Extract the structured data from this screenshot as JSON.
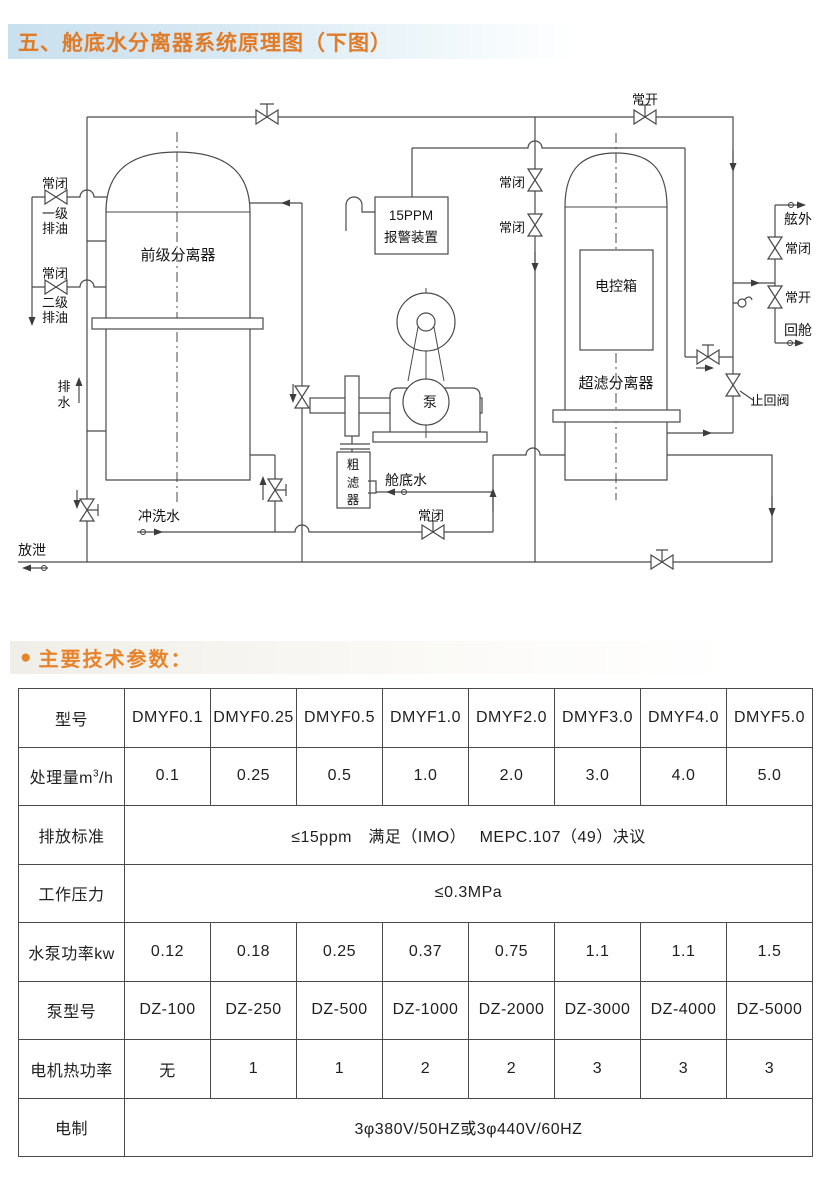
{
  "page_title": "五、舱底水分离器系统原理图（下图）",
  "params_bullet": "●",
  "params_heading": "主要技术参数：",
  "diagram": {
    "labels": {
      "normally_open": "常开",
      "normally_closed": "常闭",
      "stage1": "一级",
      "stage2": "二级",
      "oil_drain": "排油",
      "pre_separator": "前级分离器",
      "alarm_line1": "15PPM",
      "alarm_line2": "报警装置",
      "control_box": "电控箱",
      "uf_separator": "超滤分离器",
      "pump": "泵",
      "drain_char1": "排",
      "drain_char2": "水",
      "filter_char1": "粗",
      "filter_char2": "滤",
      "filter_char3": "器",
      "bilge_water": "舱底水",
      "flushing_water": "冲洗水",
      "discharge": "放泄",
      "overboard": "舷外",
      "return_cabin": "回舱",
      "check_valve": "止回阀"
    }
  },
  "table": {
    "rows": [
      {
        "label": "型号",
        "cells": [
          "DMYF0.1",
          "DMYF0.25",
          "DMYF0.5",
          "DMYF1.0",
          "DMYF2.0",
          "DMYF3.0",
          "DMYF4.0",
          "DMYF5.0"
        ]
      },
      {
        "label_pre": "处理量m",
        "label_sup": "3",
        "label_post": "/h",
        "cells": [
          "0.1",
          "0.25",
          "0.5",
          "1.0",
          "2.0",
          "3.0",
          "4.0",
          "5.0"
        ]
      },
      {
        "label": "排放标准",
        "span": "≤15ppm　满足（IMO）　 MEPC.107（49）决议"
      },
      {
        "label": "工作压力",
        "span": "≤0.3MPa"
      },
      {
        "label": "水泵功率kw",
        "cells": [
          "0.12",
          "0.18",
          "0.25",
          "0.37",
          "0.75",
          "1.1",
          "1.1",
          "1.5"
        ]
      },
      {
        "label": "泵型号",
        "cells": [
          "DZ-100",
          "DZ-250",
          "DZ-500",
          "DZ-1000",
          "DZ-2000",
          "DZ-3000",
          "DZ-4000",
          "DZ-5000"
        ]
      },
      {
        "label": "电机热功率",
        "cells": [
          "无",
          "1",
          "1",
          "2",
          "2",
          "3",
          "3",
          "3"
        ]
      },
      {
        "label": "电制",
        "span": "3φ380V/50HZ或3φ440V/60HZ"
      }
    ]
  }
}
